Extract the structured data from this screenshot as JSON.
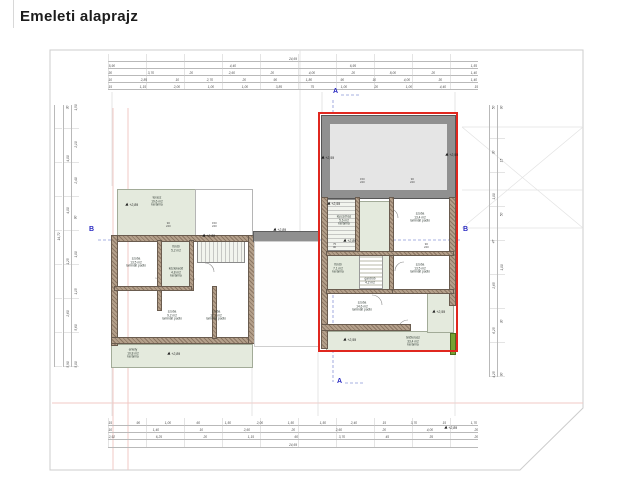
{
  "title": "Emeleti alaprajz",
  "section_markers": {
    "a": "A",
    "b": "B"
  },
  "levels": {
    "a": "+2,89",
    "b": "+2,59"
  },
  "colors": {
    "highlight_red": "#e0271f",
    "section_blue": "#2a2ac2",
    "wall_brown": "#9b8571",
    "room_green": "#e4eadd",
    "terrace_gray": "#909090",
    "planter_green": "#76a133",
    "boundary_pink": "#f2c8c4"
  },
  "dims": {
    "top": {
      "r1": [
        "24,69"
      ],
      "r2": [
        "5,90",
        "4,40",
        "6,95",
        "1,55"
      ],
      "r3": [
        "30",
        "3,70",
        "20",
        "2,60",
        "20",
        "4,00",
        "20",
        "8,00",
        "20",
        "1,40"
      ],
      "r4": [
        "10",
        "2,85",
        "10",
        "2,70",
        "20",
        "90",
        "1,80",
        "90",
        "10",
        "4,00",
        "30",
        "1,40"
      ],
      "r5": [
        "15",
        "1,15",
        "2,00",
        "1,00",
        "1,00",
        "3,85",
        "75",
        "1,00",
        "20",
        "1,00",
        "4,40",
        "15"
      ]
    },
    "bottom": {
      "r1": [
        "15",
        "90",
        "1,00",
        "60",
        "1,50",
        "2,00",
        "1,50",
        "1,50",
        "2,40",
        "15",
        "3,70",
        "15",
        "1,70"
      ],
      "r2": [
        "10",
        "1,40",
        "10",
        "2,60",
        "20",
        "2,60",
        "20",
        "4,00",
        "20"
      ],
      "r3": [
        "2,92",
        "6,25",
        "20",
        "1,15",
        "60",
        "3,70",
        "45",
        "35",
        "20"
      ],
      "r4": [
        "24,69"
      ]
    },
    "left": {
      "total": "14,72",
      "c1": [
        "30",
        "4,00",
        "4,00",
        "1,25",
        "2,60",
        "5,90"
      ],
      "c2": [
        "1,50",
        "2,10",
        "2,40",
        "90",
        "1,00",
        "1,15",
        "5,60",
        "5,00"
      ]
    },
    "right": {
      "c1": [
        "50",
        "30",
        "1,00",
        "47",
        "2,65",
        "6,25",
        "4,25"
      ],
      "c2": [
        "90",
        "15",
        "50",
        "1,00",
        "30",
        "90"
      ]
    }
  },
  "wins": {
    "a": [
      "90",
      "240"
    ],
    "b": [
      "150",
      "240"
    ],
    "c": [
      "75",
      "90"
    ]
  },
  "rooms": {
    "terasz": {
      "n": "terasz",
      "a": "19,6 m2",
      "f": "kerámia"
    },
    "szoba1": {
      "n": "szoba",
      "a": "13,5 m2",
      "f": "laminált padló"
    },
    "furdo1": {
      "n": "fürdő",
      "a": "5,2 m2",
      "f": "kerámia"
    },
    "kozl1": {
      "n": "közlekedő",
      "a": "4,8 m2",
      "f": "kerámia"
    },
    "szoba2": {
      "n": "szoba",
      "a": "9,2 m2",
      "f": "laminált padló"
    },
    "szoba3": {
      "n": "szoba",
      "a": "12,1 m2",
      "f": "laminált padló"
    },
    "erkely": {
      "n": "erkély",
      "a": "10,8 m2",
      "f": "kerámia"
    },
    "lepcso": {
      "n": "lépcsőház",
      "a": "5,6 m2",
      "f": "kerámia"
    },
    "szoba4": {
      "n": "szoba",
      "a": "13,4 m2",
      "f": "laminált padló"
    },
    "furdo2": {
      "n": "fürdő",
      "a": "7,1 m2",
      "f": "kerámia"
    },
    "gardrob": {
      "n": "gardrób",
      "a": "4,2 m2",
      "f": ""
    },
    "szoba5": {
      "n": "szoba",
      "a": "13,5 m2",
      "f": "laminált padló"
    },
    "szoba6": {
      "n": "szoba",
      "a": "14,6 m2",
      "f": "laminált padló"
    },
    "tetoterasz": {
      "n": "tetőterasz",
      "a": "33,4 m2",
      "f": "kerámia"
    }
  }
}
